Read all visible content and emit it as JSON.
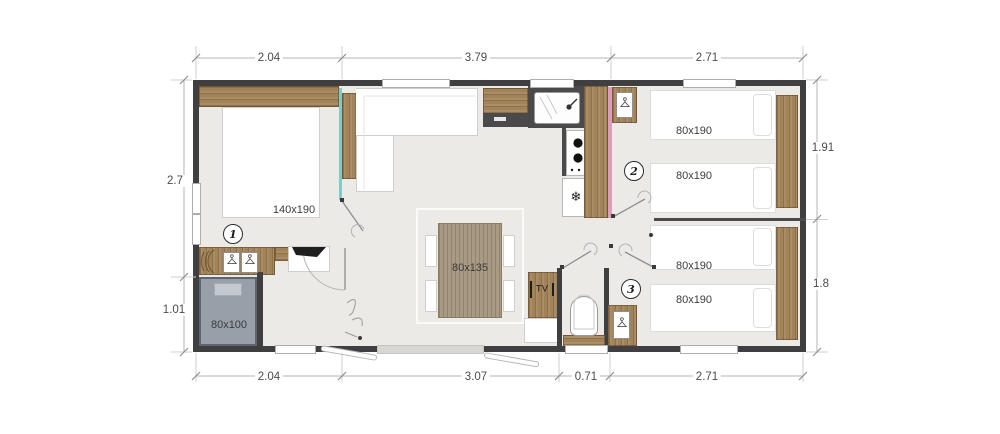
{
  "floorplan": {
    "dims_top": [
      {
        "label": "2.04"
      },
      {
        "label": "3.79"
      },
      {
        "label": "2.71"
      }
    ],
    "dims_bottom": [
      {
        "label": "2.04"
      },
      {
        "label": "3.07"
      },
      {
        "label": "0.71"
      },
      {
        "label": "2.71"
      }
    ],
    "dims_left": [
      {
        "label": "2.7"
      },
      {
        "label": "1.01"
      }
    ],
    "dims_right": [
      {
        "label": "1.91"
      },
      {
        "label": "1.8"
      }
    ],
    "rooms": [
      {
        "number": "1"
      },
      {
        "number": "2"
      },
      {
        "number": "3"
      }
    ],
    "furniture": {
      "bed_master": "140x190",
      "bed_small": "80x100",
      "dining_table": "80x135",
      "tv": "TV",
      "bed_r2_a": "80x190",
      "bed_r2_b": "80x190",
      "bed_r3_a": "80x190",
      "bed_r3_b": "80x190"
    },
    "glyphs": {
      "snowflake": "❄"
    },
    "colors": {
      "wall": "#3f3f3f",
      "wood": "#a1835a",
      "floor": "#ebeae7",
      "glass_teal": "#7fccc6",
      "accent_pink": "#dc9ebc",
      "bed_gray": "#97a0a9"
    }
  }
}
